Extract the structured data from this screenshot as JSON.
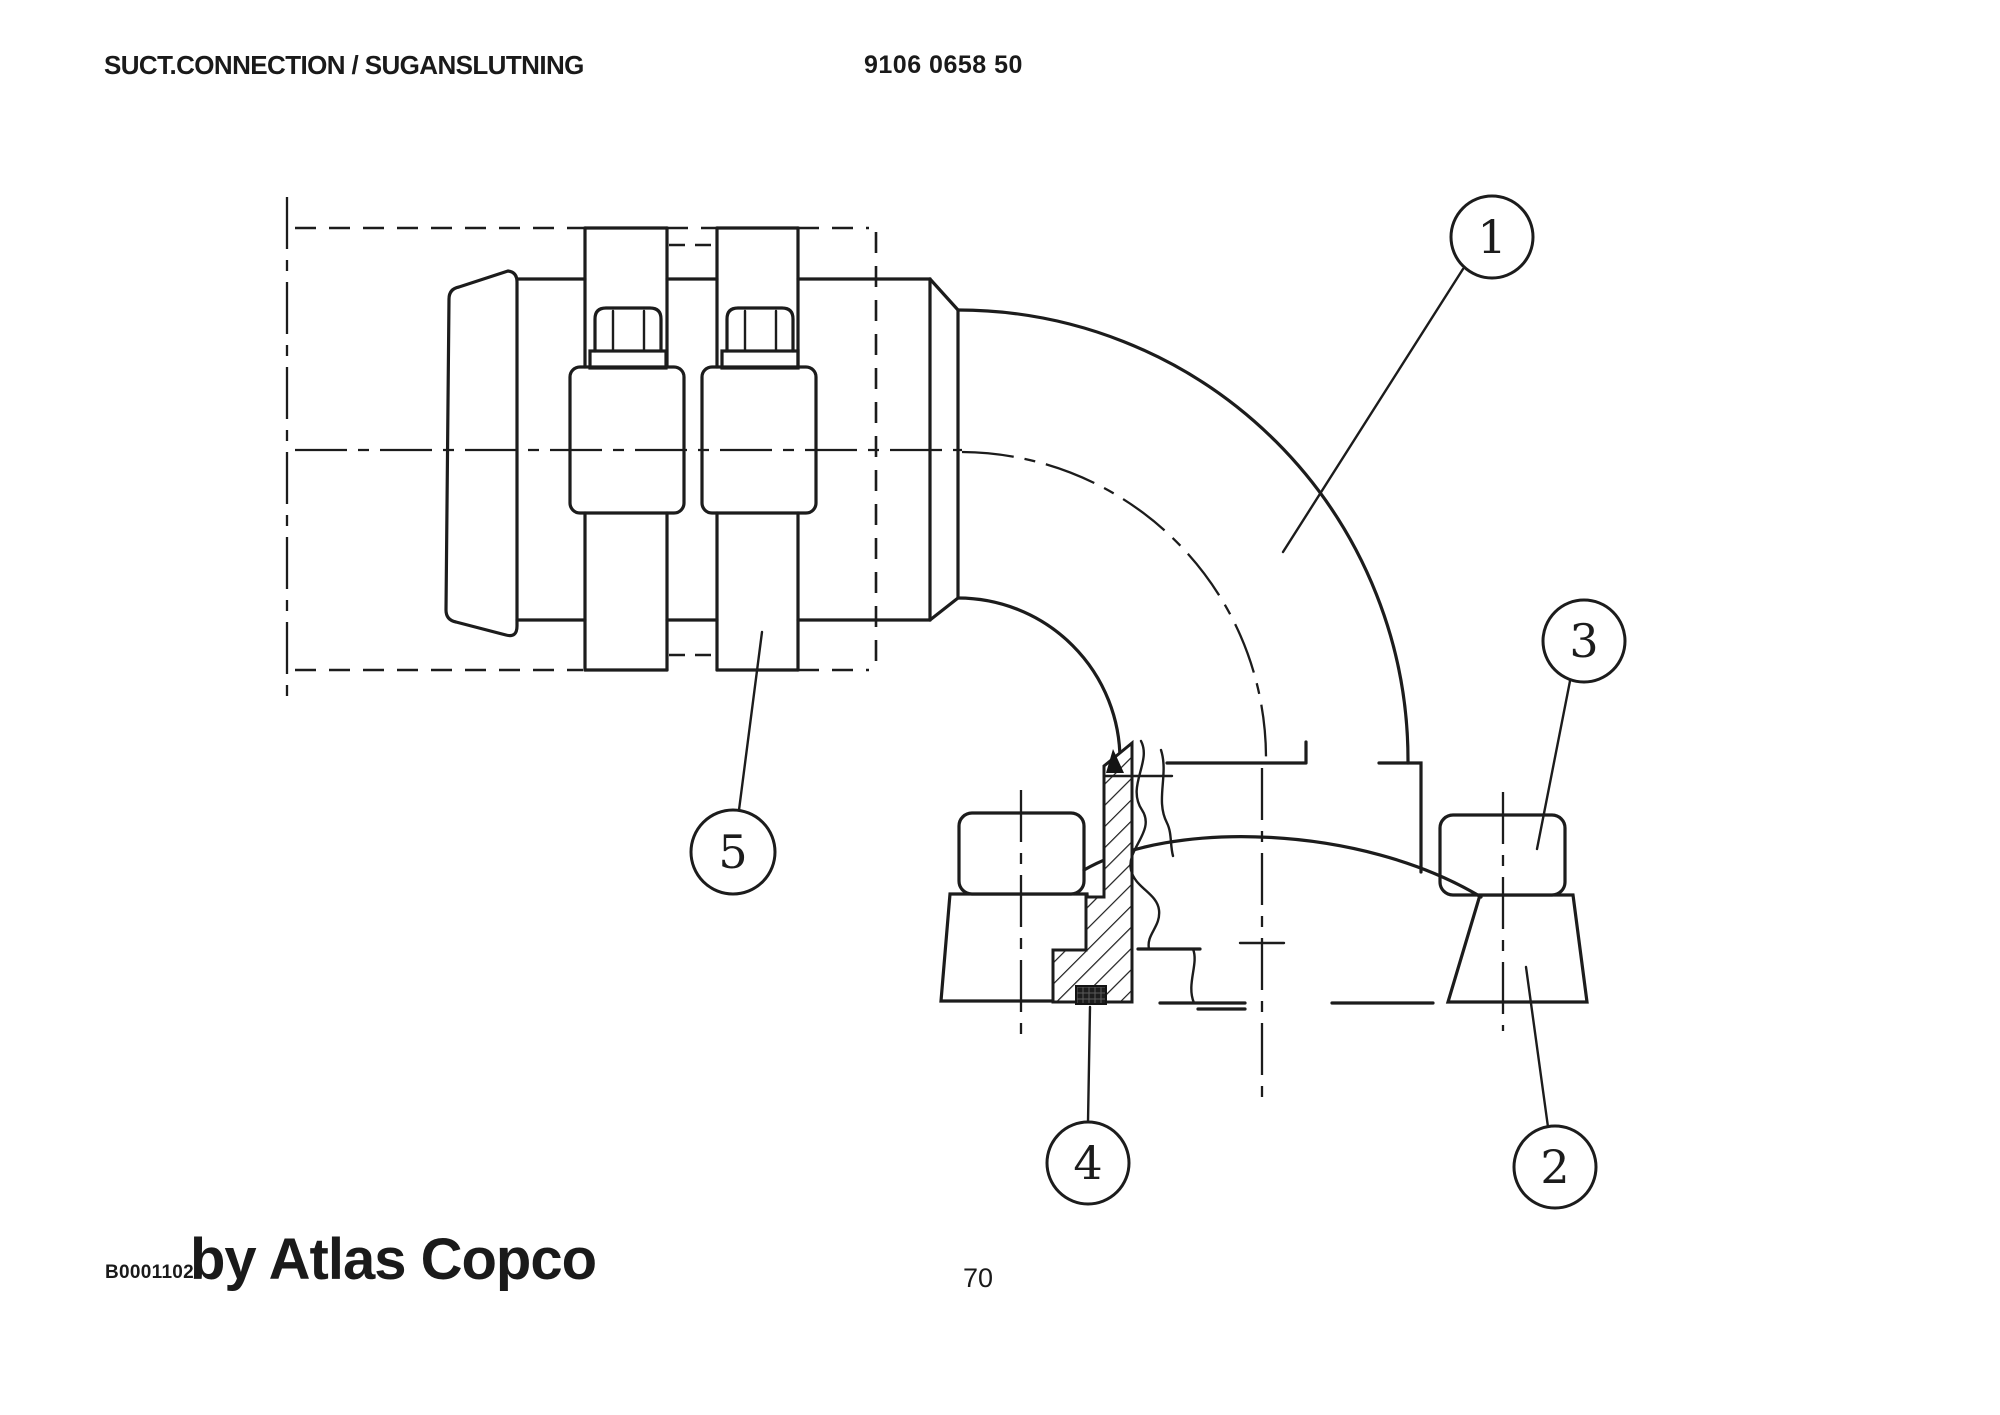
{
  "header": {
    "title": "SUCT.CONNECTION / SUGANSLUTNING",
    "part_number": "9106 0658 50"
  },
  "footer": {
    "doc_code": "B0001102",
    "brand": "by Atlas Copco",
    "page_number": "70"
  },
  "drawing": {
    "callouts": [
      {
        "label": "1"
      },
      {
        "label": "2"
      },
      {
        "label": "3"
      },
      {
        "label": "4"
      },
      {
        "label": "5"
      }
    ]
  }
}
